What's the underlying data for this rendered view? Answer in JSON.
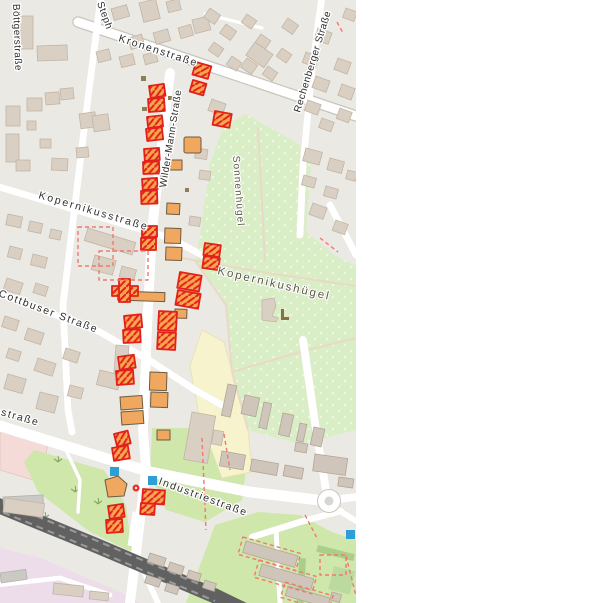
{
  "map": {
    "labels": {
      "boettgerstrasse": "Böttgerstraße",
      "stephanstrasse_partial": "Steph",
      "kronenstrasse": "Kronenstraße",
      "rechenberger_strasse": "Rechenberger Straße",
      "wilder_mann_strasse": "Wilder-Mann-Straße",
      "sonnenhuegel": "Sonnenhügel",
      "kopernikusstrasse": "Kopernikusstraße",
      "kopernikushuegel": "Kopernikushügel",
      "cottbuser_strasse": "Cottbuser Straße",
      "industriestrasse_west": "Industriestraße",
      "industriestrasse_mid": "Industriestraße"
    },
    "icons": {
      "blue_square_marker": "blue-square-marker",
      "mini_roundabout": "mini-roundabout-dot",
      "viewpoint": "viewpoint-icon"
    }
  },
  "colors": {
    "map_bg": "#ebe9e4",
    "building_fill": "#d9cfc3",
    "building_stroke": "#c2b5a6",
    "building2_fill": "#cfc5ba",
    "building2_stroke": "#b2a698",
    "grey_building": "#cbc9c4",
    "highlight_fill": "#f8a64f",
    "highlight_stroke": "#e2211c",
    "orange_fill": "#f0a75f",
    "orange_stroke": "#6f5b40",
    "dashed_red": "#f07a6e",
    "park_fill": "#d9eec6",
    "park_dot": "#ecf7de",
    "gardens_fill": "#cfe7ab",
    "hedge_fill": "#a9cf8b",
    "yellow_fill": "#f6f3cd",
    "pink_fill": "#f5dbd7",
    "railpink_fill": "#eddcea",
    "railway_dark": "#616161",
    "railway_light": "#9a9a9a",
    "road_fill": "#ffffff",
    "road_casing": "#c9c5bd",
    "path_fill": "#e9d9c6",
    "blue_marker": "#2d9fd6",
    "mini_roundabout_red": "#e63228",
    "street_label": "#2e2e2e",
    "area_label": "#5e564a",
    "viewpoint_brown": "#8d6e3f"
  }
}
